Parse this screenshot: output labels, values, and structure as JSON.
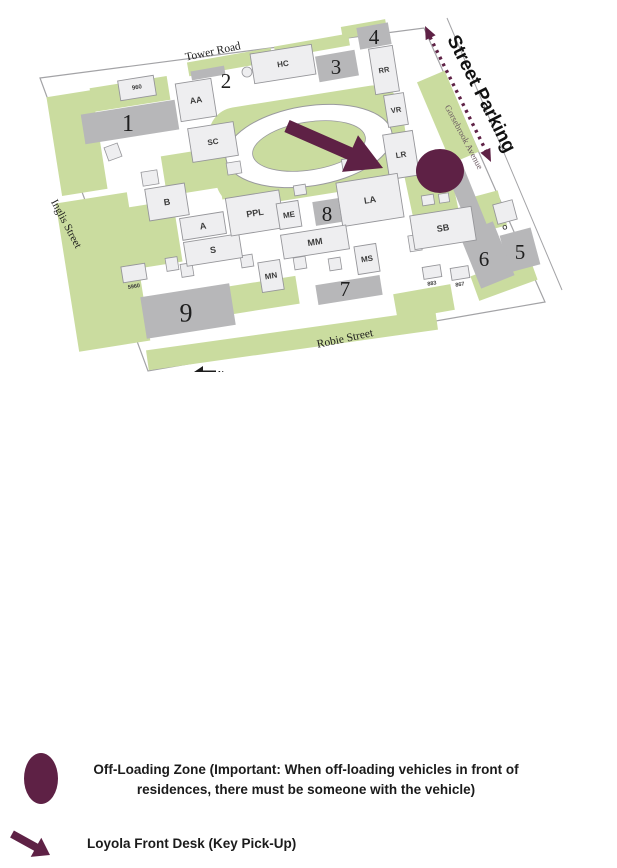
{
  "colors": {
    "maroon": "#5e2145",
    "green": "#cadc9f",
    "lot_gray": "#b7b7b9",
    "building_fill": "#eeeef0",
    "building_stroke": "#96969a",
    "outline": "#a3a3a6",
    "street_text": "#1c1c1c",
    "gorsebrook_text": "#6a5860",
    "building_label_text": "#3b3b3b",
    "number_text": "#1f1f1f"
  },
  "map": {
    "street_parking_label": "Street Parking",
    "north_label": "N",
    "streets": [
      {
        "name": "Tower Road",
        "x": 213,
        "y": 52,
        "rot": -12,
        "fs": 11.5,
        "color": "#1c1c1c"
      },
      {
        "name": "Inglis Street",
        "x": 66,
        "y": 224,
        "rot": 62,
        "fs": 11,
        "color": "#1c1c1c"
      },
      {
        "name": "Robie Street",
        "x": 345,
        "y": 339,
        "rot": -12,
        "fs": 11.5,
        "color": "#1c1c1c"
      },
      {
        "name": "Gorsebrook Avenue",
        "x": 464,
        "y": 137,
        "rot": 62,
        "fs": 9,
        "color": "#6a5860"
      }
    ],
    "lots": [
      {
        "label": "1",
        "x": 130,
        "y": 122,
        "w": 95,
        "h": 30,
        "rot": -9,
        "nx": 128,
        "ny": 124,
        "fs": 24
      },
      {
        "label": "2",
        "x": 208,
        "y": 73,
        "w": 34,
        "h": 9,
        "rot": -10,
        "nx": 226,
        "ny": 81,
        "fs": 21
      },
      {
        "label": "3",
        "x": 337,
        "y": 66,
        "w": 40,
        "h": 26,
        "rot": -10,
        "nx": 336,
        "ny": 67,
        "fs": 21
      },
      {
        "label": "4",
        "x": 374,
        "y": 36,
        "w": 32,
        "h": 22,
        "rot": -10,
        "nx": 374,
        "ny": 37,
        "fs": 21
      },
      {
        "label": "5",
        "x": 520,
        "y": 250,
        "w": 32,
        "h": 38,
        "rot": -15,
        "nx": 520,
        "ny": 252,
        "fs": 21
      },
      {
        "label": "6",
        "x": 487,
        "y": 255,
        "w": 36,
        "h": 58,
        "rot": -22,
        "nx": 484,
        "ny": 259,
        "fs": 21
      },
      {
        "label": "7",
        "x": 349,
        "y": 290,
        "w": 65,
        "h": 20,
        "rot": -9,
        "nx": 345,
        "ny": 289,
        "fs": 21
      },
      {
        "label": "8",
        "x": 327,
        "y": 212,
        "w": 26,
        "h": 24,
        "rot": -9,
        "nx": 327,
        "ny": 214,
        "fs": 21
      },
      {
        "label": "9",
        "x": 188,
        "y": 311,
        "w": 90,
        "h": 42,
        "rot": -9,
        "nx": 186,
        "ny": 313,
        "fs": 26
      }
    ],
    "buildings": [
      {
        "label": "960",
        "x": 137,
        "y": 88,
        "w": 36,
        "h": 20,
        "fs": 6,
        "rot": -9
      },
      {
        "label": "AA",
        "x": 196,
        "y": 100,
        "w": 36,
        "h": 38,
        "fs": 8.5,
        "rot": -9
      },
      {
        "label": "HC",
        "x": 283,
        "y": 64,
        "w": 62,
        "h": 30,
        "fs": 8,
        "rot": -9
      },
      {
        "label": "SC",
        "x": 213,
        "y": 142,
        "w": 46,
        "h": 34,
        "fs": 8,
        "rot": -9
      },
      {
        "label": "RR",
        "x": 384,
        "y": 70,
        "w": 24,
        "h": 46,
        "fs": 7.5,
        "rot": -9
      },
      {
        "label": "VR",
        "x": 396,
        "y": 110,
        "w": 20,
        "h": 32,
        "fs": 7.5,
        "rot": -9
      },
      {
        "label": "LR",
        "x": 401,
        "y": 155,
        "w": 30,
        "h": 45,
        "fs": 8,
        "rot": -9
      },
      {
        "label": "LA",
        "x": 370,
        "y": 200,
        "w": 62,
        "h": 44,
        "fs": 9,
        "rot": -9
      },
      {
        "label": "B",
        "x": 167,
        "y": 202,
        "w": 40,
        "h": 32,
        "fs": 9,
        "rot": -9
      },
      {
        "label": "A",
        "x": 203,
        "y": 226,
        "w": 44,
        "h": 22,
        "fs": 9,
        "rot": -9
      },
      {
        "label": "S",
        "x": 213,
        "y": 250,
        "w": 56,
        "h": 24,
        "fs": 9,
        "rot": -9
      },
      {
        "label": "PPL",
        "x": 255,
        "y": 213,
        "w": 54,
        "h": 38,
        "fs": 9,
        "rot": -9
      },
      {
        "label": "ME",
        "x": 289,
        "y": 215,
        "w": 22,
        "h": 26,
        "fs": 8,
        "rot": -9
      },
      {
        "label": "MM",
        "x": 315,
        "y": 242,
        "w": 66,
        "h": 24,
        "fs": 9,
        "rot": -9
      },
      {
        "label": "MN",
        "x": 271,
        "y": 276,
        "w": 22,
        "h": 30,
        "fs": 8,
        "rot": -9
      },
      {
        "label": "MS",
        "x": 367,
        "y": 259,
        "w": 22,
        "h": 28,
        "fs": 8,
        "rot": -9
      },
      {
        "label": "SB",
        "x": 443,
        "y": 228,
        "w": 62,
        "h": 34,
        "fs": 9,
        "rot": -9
      },
      {
        "label": "O",
        "x": 505,
        "y": 212,
        "w": 20,
        "h": 20,
        "fs": 6.5,
        "rot": -15,
        "below": true
      },
      {
        "label": "883",
        "x": 432,
        "y": 272,
        "w": 18,
        "h": 12,
        "fs": 5.5,
        "rot": -9,
        "below": true
      },
      {
        "label": "867",
        "x": 460,
        "y": 273,
        "w": 18,
        "h": 12,
        "fs": 5.5,
        "rot": -9,
        "below": true
      },
      {
        "label": "5960",
        "x": 134,
        "y": 273,
        "w": 24,
        "h": 16,
        "fs": 5.5,
        "rot": -9,
        "below": true
      }
    ]
  },
  "legend": {
    "items": [
      {
        "icon": "off-loading-circle",
        "text": "Off-Loading Zone (Important: When off-loading vehicles in front of residences, there must be someone with the vehicle)"
      },
      {
        "icon": "maroon-arrow",
        "text": "Loyola Front Desk (Key Pick-Up)"
      }
    ]
  }
}
